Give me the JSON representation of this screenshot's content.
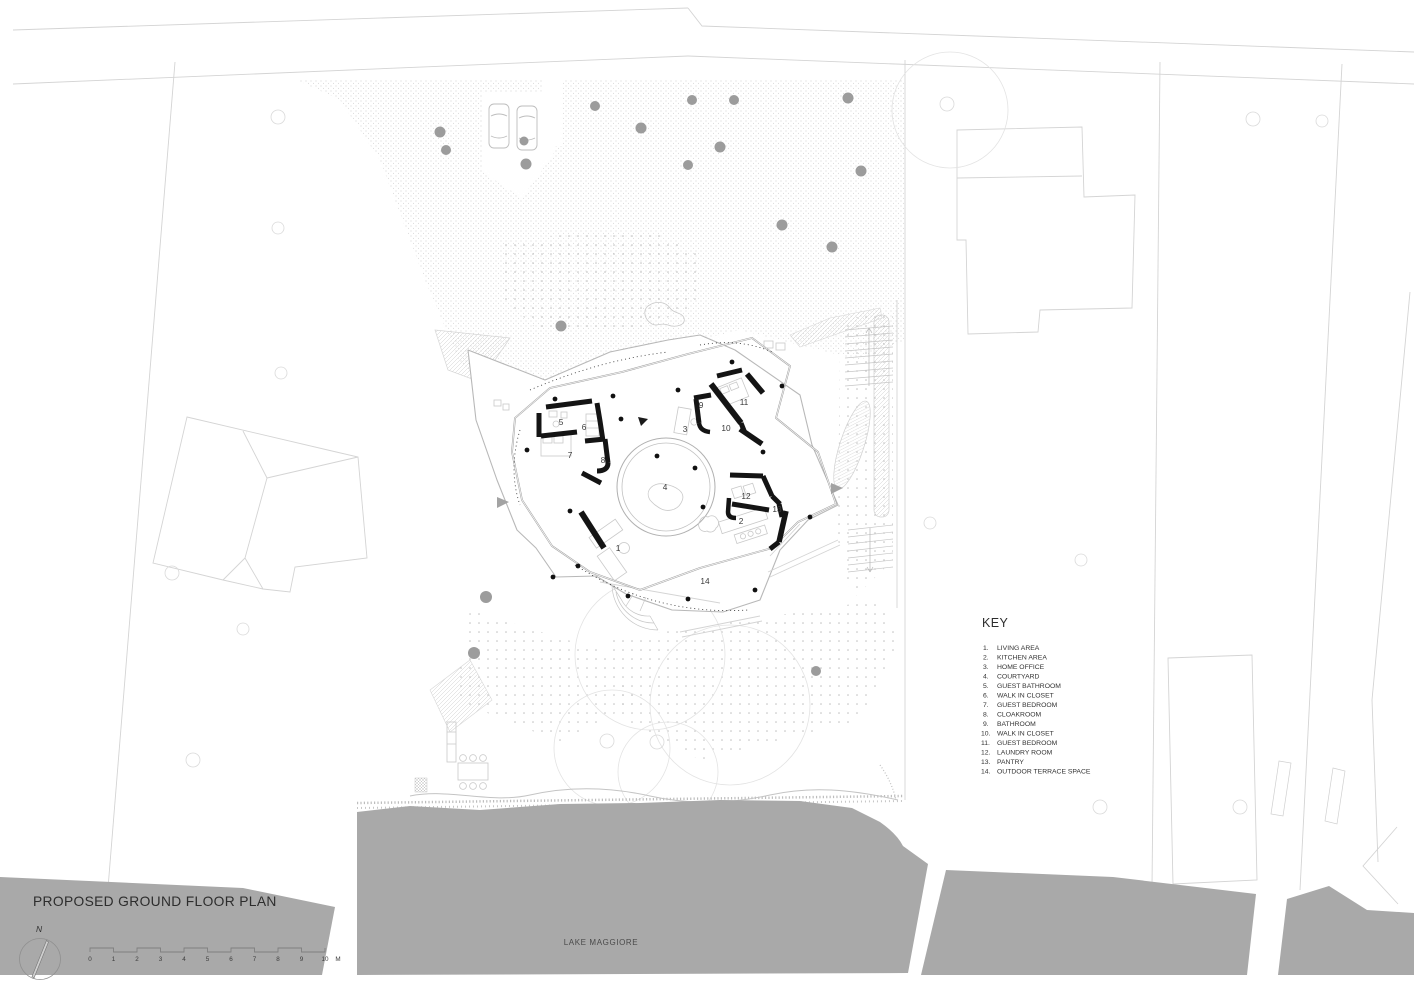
{
  "title": "PROPOSED GROUND FLOOR PLAN",
  "north_label": "N",
  "lake_label": "LAKE MAGGIORE",
  "scale_bar": {
    "labels": [
      "0",
      "1",
      "2",
      "3",
      "4",
      "5",
      "6",
      "7",
      "8",
      "9",
      "10"
    ],
    "unit": "M"
  },
  "key": {
    "heading": "KEY",
    "items": [
      {
        "num": "1.",
        "label": "LIVING AREA"
      },
      {
        "num": "2.",
        "label": "KITCHEN AREA"
      },
      {
        "num": "3.",
        "label": "HOME OFFICE"
      },
      {
        "num": "4.",
        "label": "COURTYARD"
      },
      {
        "num": "5.",
        "label": "GUEST BATHROOM"
      },
      {
        "num": "6.",
        "label": "WALK IN CLOSET"
      },
      {
        "num": "7.",
        "label": "GUEST BEDROOM"
      },
      {
        "num": "8.",
        "label": "CLOAKROOM"
      },
      {
        "num": "9.",
        "label": "BATHROOM"
      },
      {
        "num": "10.",
        "label": "WALK IN CLOSET"
      },
      {
        "num": "11.",
        "label": "GUEST BEDROOM"
      },
      {
        "num": "12.",
        "label": "LAUNDRY ROOM"
      },
      {
        "num": "13.",
        "label": "PANTRY"
      },
      {
        "num": "14.",
        "label": "OUTDOOR TERRACE SPACE"
      }
    ]
  },
  "plan": {
    "rooms": [
      "1",
      "2",
      "3",
      "4",
      "5",
      "6",
      "7",
      "8",
      "9",
      "10",
      "11",
      "12",
      "13",
      "14"
    ]
  },
  "colors": {
    "lake_gray": "#a9a9a9",
    "wall_black": "#141414",
    "site_line": "#d4d4d4",
    "text_dark": "#2d2d2d"
  }
}
